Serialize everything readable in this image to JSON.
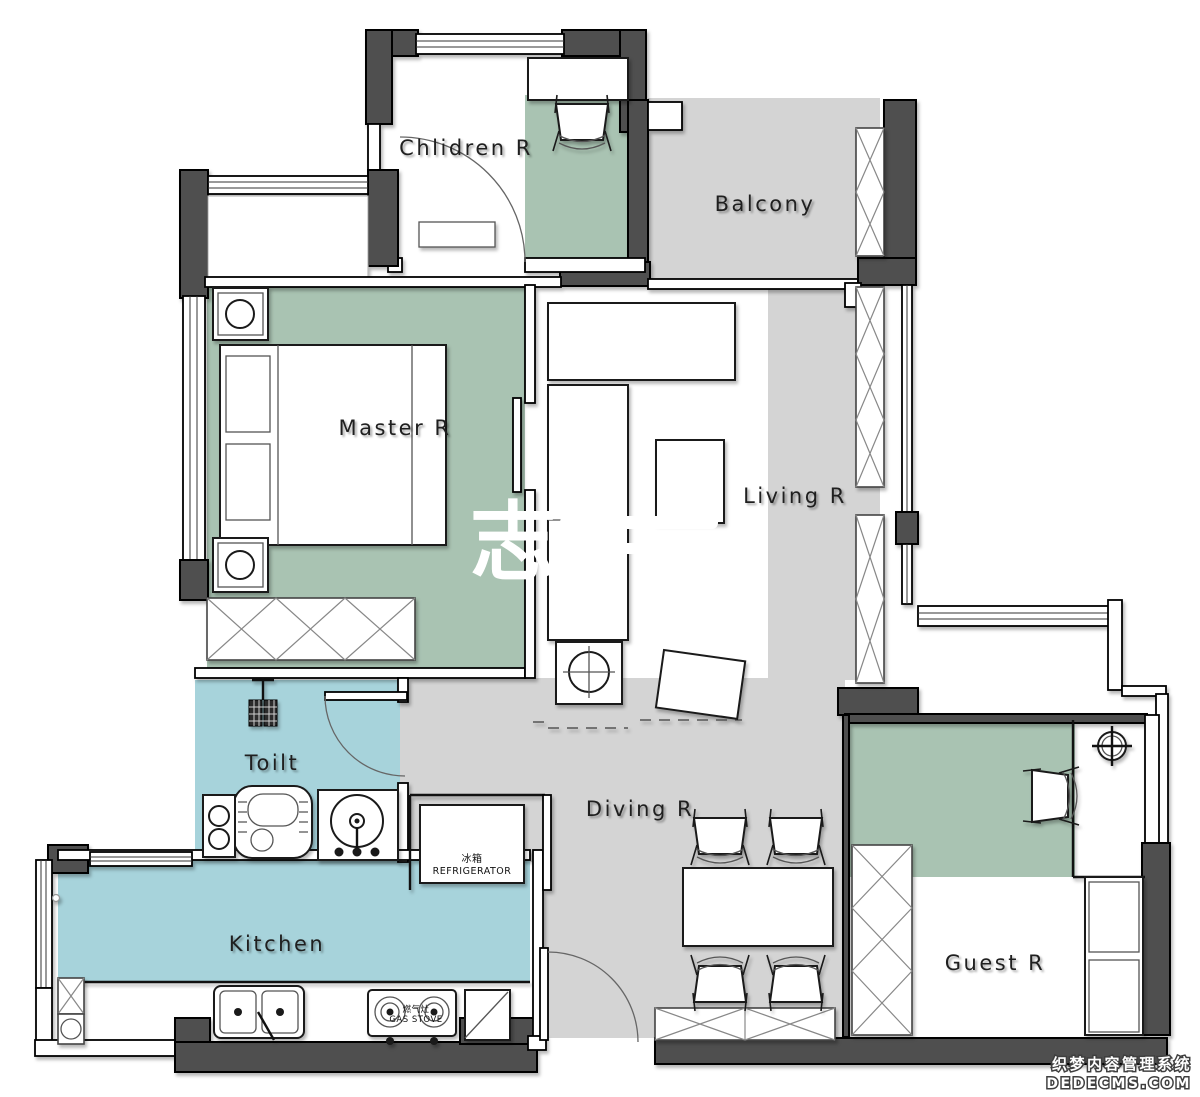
{
  "rooms": {
    "children": {
      "label": "Chlidren R"
    },
    "balcony": {
      "label": "Balcony"
    },
    "master": {
      "label": "Master R"
    },
    "living": {
      "label": "Living R"
    },
    "toilet": {
      "label": "Toilt"
    },
    "dining": {
      "label": "Diving R"
    },
    "kitchen": {
      "label": "Kitchen"
    },
    "guest": {
      "label": "Guest R"
    }
  },
  "appliances": {
    "refrigerator": {
      "cn": "冰箱",
      "en": "REFRIGERATOR"
    },
    "gas_stove": {
      "cn": "燃气灶",
      "en": "GAS STOVE"
    }
  },
  "watermarks": {
    "center": "志",
    "brand_cn": "织梦内容管理系统",
    "brand_en": "DEDECMS.COM"
  },
  "colors": {
    "wall_dark": "#4f4f4f",
    "floor_green": "#a9c3b2",
    "floor_blue": "#a7d3db",
    "floor_gray": "#d4d4d4",
    "label_ink": "#1f1f1f",
    "watermark_white": "#ffffff"
  }
}
